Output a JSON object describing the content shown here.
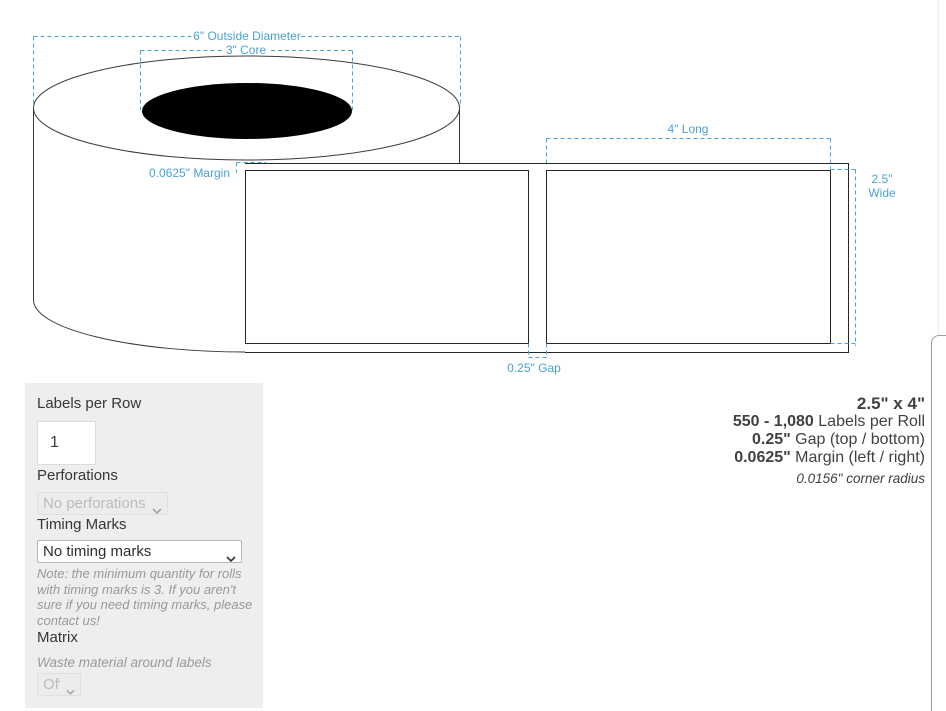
{
  "diagram": {
    "accent_color": "#4aa4d3",
    "line_color": "#3a3a3a",
    "measurements": {
      "outside_diameter": "6\" Outside Diameter",
      "core": "3\" Core",
      "margin": "0.0625\" Margin",
      "long": "4\" Long",
      "wide_line1": "2.5\"",
      "wide_line2": "Wide",
      "gap": "0.25\" Gap"
    }
  },
  "specs": {
    "size": "2.5\" x 4\"",
    "labels_per_roll_value": "550 - 1,080",
    "labels_per_roll_label": " Labels per Roll",
    "gap_value": "0.25\"",
    "gap_label": " Gap (top / bottom)",
    "margin_value": "0.0625\"",
    "margin_label": " Margin (left / right)",
    "corner_radius": "0.0156\" corner radius"
  },
  "form": {
    "labels_per_row_label": "Labels per Row",
    "labels_per_row_value": "1",
    "perforations_label": "Perforations",
    "perforations_value": "No perforations",
    "timing_marks_label": "Timing Marks",
    "timing_marks_value": "No timing marks",
    "timing_note": "Note: the minimum quantity for rolls with timing marks is 3. If you aren't sure if you need timing marks, please contact us!",
    "matrix_label": "Matrix",
    "matrix_desc": "Waste material around labels",
    "matrix_value": "Off"
  }
}
